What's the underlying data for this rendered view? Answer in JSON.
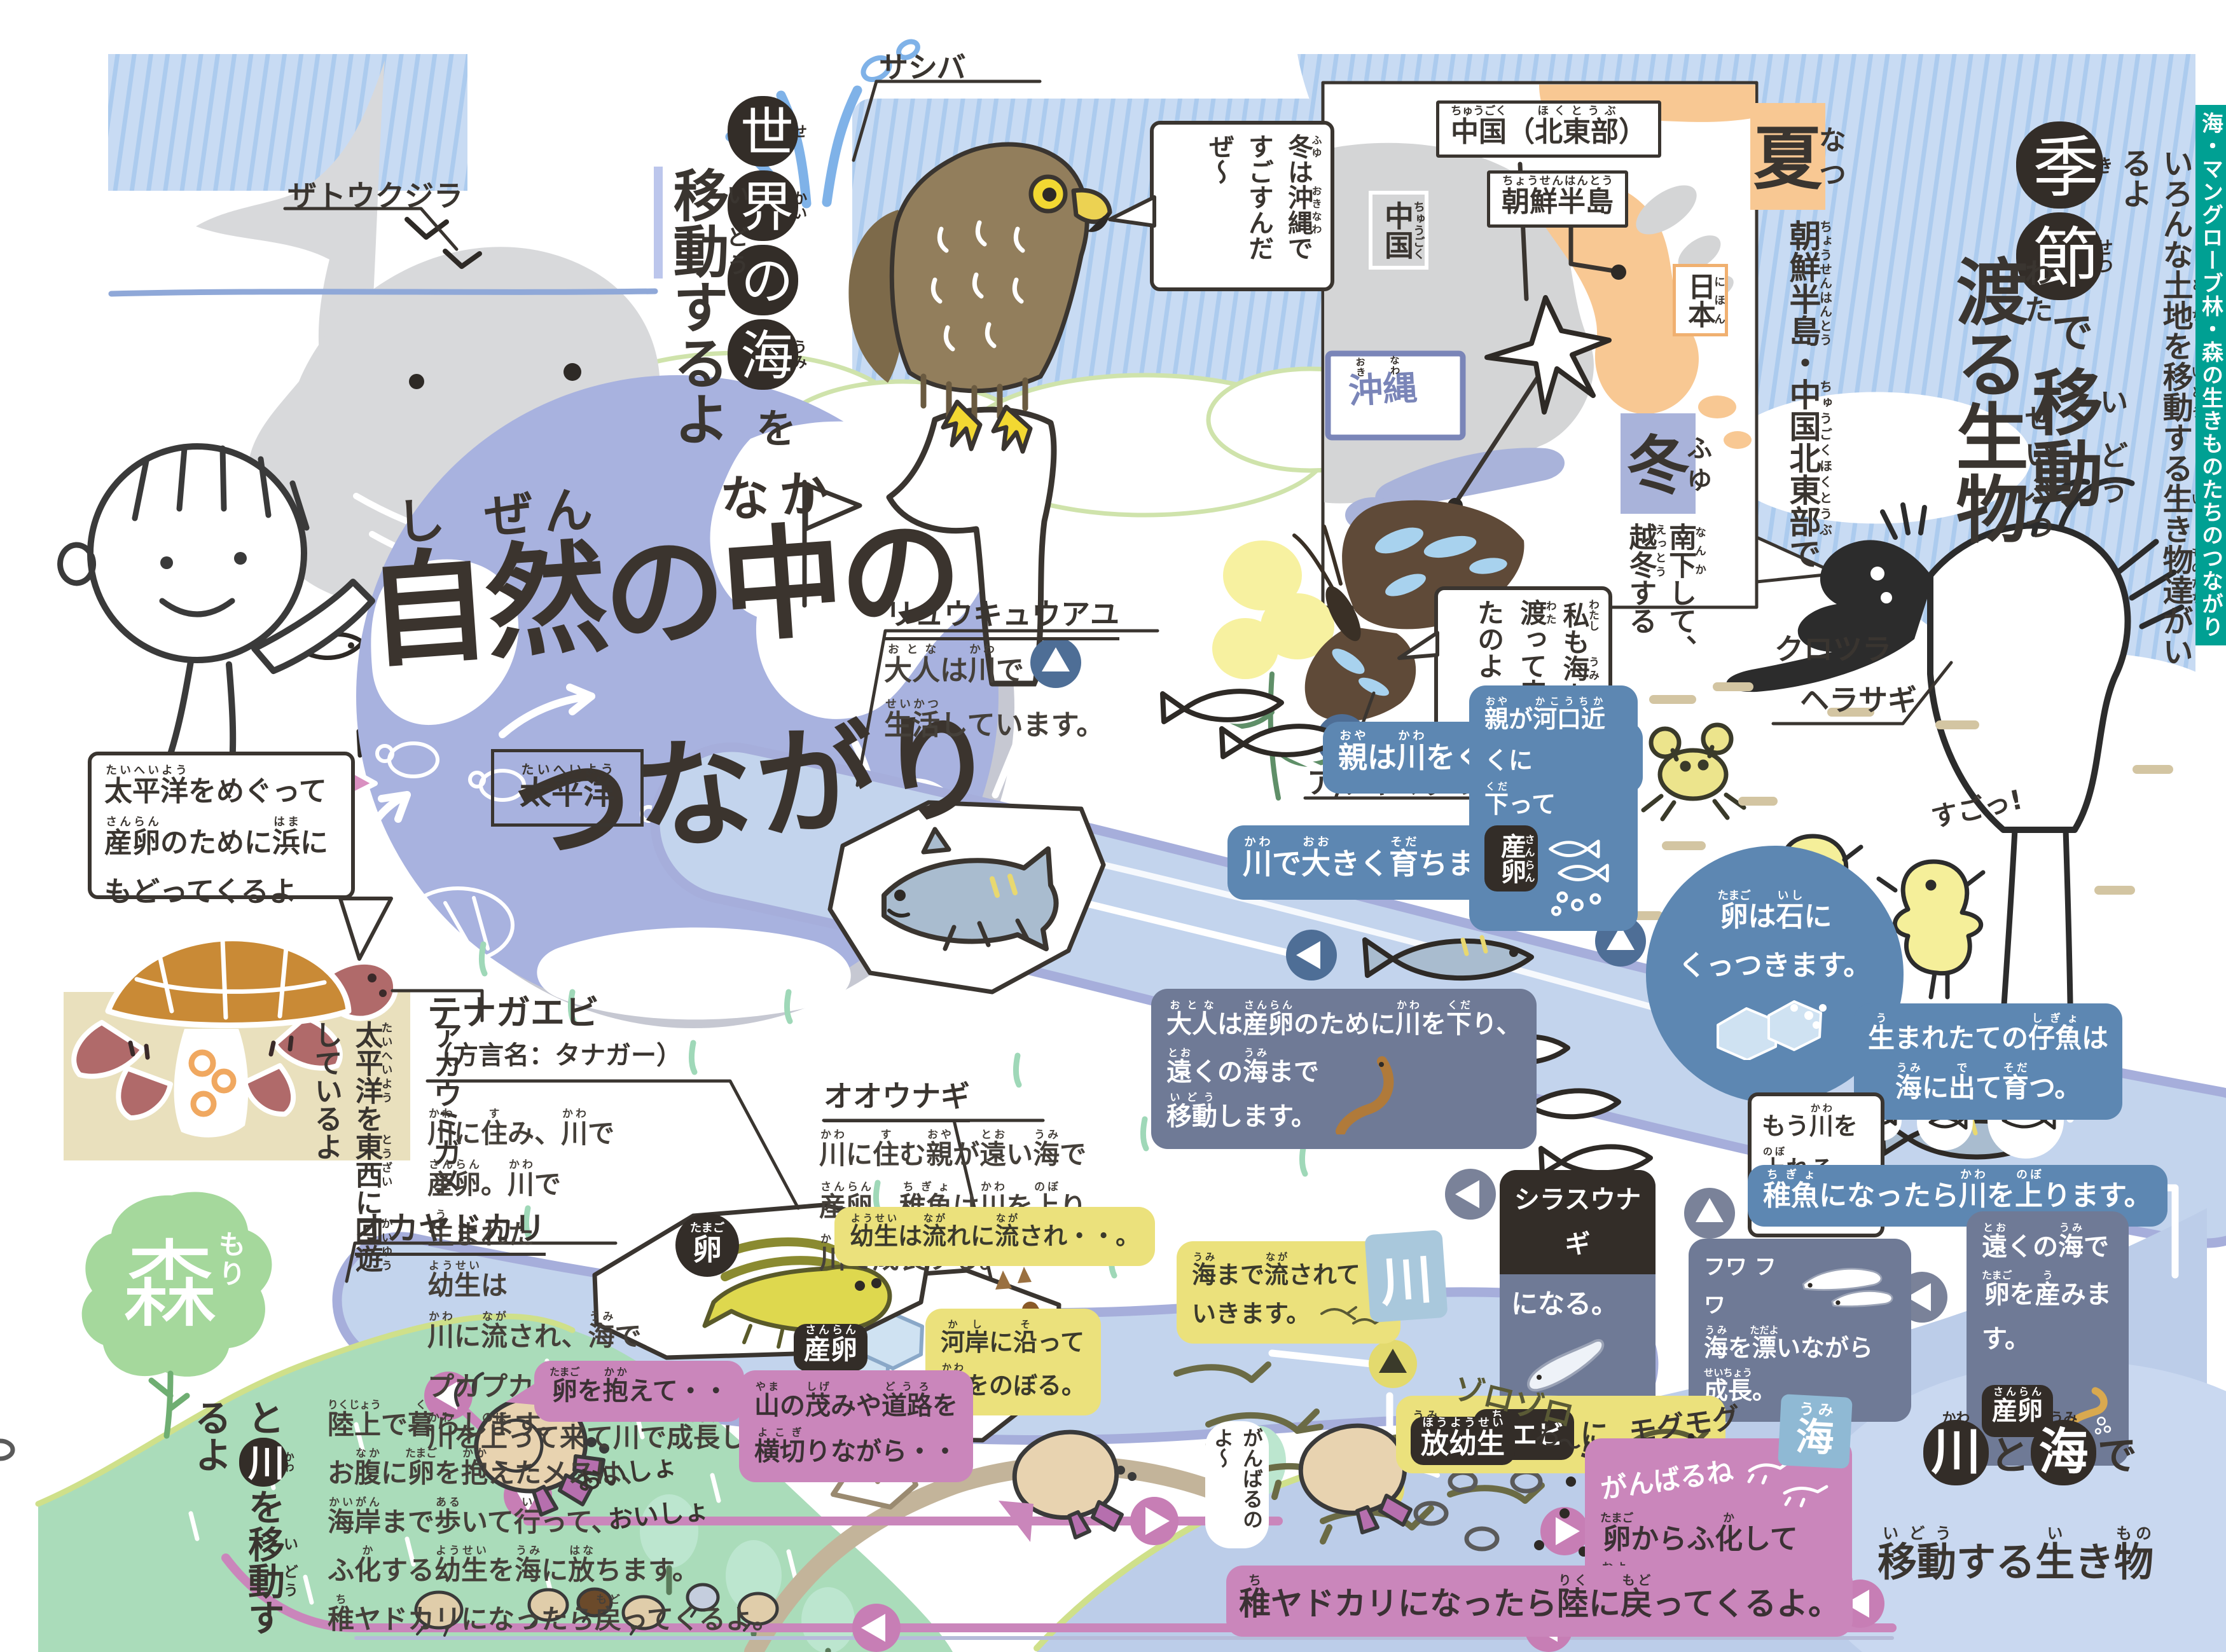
{
  "colors": {
    "accent_teal": "#00a093",
    "badge_blue": "#5d87b2",
    "badge_slate": "#6f7a96",
    "badge_yellow": "#ebe17c",
    "badge_pink": "#ca86bb",
    "badge_black": "#332d28",
    "globe": "#a8b2df",
    "river": "#c3d4ed",
    "sea": "#bccde9",
    "summer_orange": "#f8c893",
    "winter_lavender": "#a9b3da",
    "mountain_green": "#aadcba"
  },
  "tab": {
    "label": "海・マングローブ林・森の生きものたちのつながり"
  },
  "title": {
    "line1": [
      [
        "自",
        "し"
      ],
      [
        "然",
        "ぜん"
      ],
      [
        "の",
        ""
      ],
      [
        "中",
        "なか"
      ],
      [
        "の",
        ""
      ]
    ],
    "line2": "つながり"
  },
  "whale": {
    "label": "ザトウクジラ"
  },
  "world_title": {
    "part1": [
      [
        "世",
        "せ"
      ],
      [
        "界",
        "かい"
      ],
      [
        "の",
        ""
      ],
      [
        "海",
        "うみ"
      ]
    ],
    "part2": "を",
    "part3": [
      [
        "移",
        "い"
      ],
      [
        "動",
        "どう"
      ],
      [
        "するよ",
        ""
      ]
    ]
  },
  "hawk": {
    "label": "サシバ",
    "bubble": [
      [
        "冬",
        "ふゆ"
      ],
      [
        "は",
        ""
      ],
      [
        "沖縄",
        "おきなわ"
      ],
      [
        "ですごすんだぜ～",
        ""
      ]
    ]
  },
  "map": {
    "china_ne": [
      [
        "中国",
        "ちゅうごく"
      ],
      [
        "（",
        ""
      ],
      [
        "北東部",
        "ほくとうぶ"
      ],
      [
        "）",
        ""
      ]
    ],
    "korea": [
      [
        "朝鮮半島",
        "ちょうせんはんとう"
      ]
    ],
    "china": [
      [
        "中国",
        "ちゅうごく"
      ]
    ],
    "japan": [
      [
        "日本",
        "にほん"
      ]
    ],
    "okinawa": [
      [
        "沖",
        "おき"
      ],
      [
        "縄",
        "なわ"
      ]
    ],
    "summer": [
      [
        "夏",
        "なつ"
      ]
    ],
    "winter": [
      [
        "冬",
        "ふゆ"
      ]
    ],
    "winter_note": [
      [
        "南下",
        "なんか"
      ],
      [
        "して、",
        ""
      ],
      [
        "越冬",
        "えっとう"
      ],
      [
        "する",
        ""
      ]
    ],
    "breeding_note": [
      [
        "朝鮮半島",
        "ちょうせんはんとう"
      ],
      [
        "・",
        ""
      ],
      [
        "中国北東部",
        "ちゅうごくほくとうぶ"
      ],
      [
        "で",
        ""
      ]
    ]
  },
  "season": {
    "t1": [
      [
        "季",
        "き"
      ],
      [
        "節",
        "せつ"
      ]
    ],
    "t2": "で",
    "t3": [
      [
        "移",
        "い"
      ],
      [
        "動",
        "どう"
      ]
    ],
    "t4": [
      [
        "渡",
        "わた"
      ],
      [
        "る",
        ""
      ],
      [
        "生",
        "せい"
      ],
      [
        "物",
        "ぶつ"
      ]
    ],
    "subtitle": [
      [
        "いろんな",
        ""
      ],
      [
        "土地",
        "とち"
      ],
      [
        "を",
        ""
      ],
      [
        "移動",
        "いどう"
      ],
      [
        "する",
        ""
      ],
      [
        "生",
        "い"
      ],
      [
        "き",
        ""
      ],
      [
        "物達",
        "ものたち"
      ],
      [
        "がいるよ",
        ""
      ]
    ]
  },
  "butterfly": {
    "label": "アサギマダラ",
    "bubble": [
      [
        "私",
        "わたし"
      ],
      [
        "も",
        ""
      ],
      [
        "海",
        "うみ"
      ],
      [
        "を",
        ""
      ],
      [
        "渡",
        "わた"
      ],
      [
        "って",
        ""
      ],
      [
        "来",
        "き"
      ],
      [
        "たのよ",
        ""
      ]
    ]
  },
  "spoonbill": {
    "label_l1": "クロツラ",
    "label_l2": "ヘラサギ",
    "chick_note": "すごっ!"
  },
  "globe": {
    "ocean": [
      [
        "太平洋",
        "たいへいよう"
      ]
    ],
    "turtle_bubble_l1": [
      [
        "太平洋",
        "たいへいよう"
      ],
      [
        "をめぐって",
        ""
      ]
    ],
    "turtle_bubble_l2": [
      [
        "産卵",
        "さんらん"
      ],
      [
        "のために",
        ""
      ],
      [
        "浜",
        "はま"
      ],
      [
        "に",
        ""
      ]
    ],
    "turtle_bubble_l3": [
      [
        "もどってくるよ",
        ""
      ]
    ]
  },
  "loggerhead": {
    "label": "アカウミガメ",
    "note": [
      [
        "太平洋",
        "たいへいよう"
      ],
      [
        "を",
        ""
      ],
      [
        "東西",
        "とうざい"
      ],
      [
        "に",
        ""
      ],
      [
        "回遊",
        "かいゆう"
      ],
      [
        "しているよ",
        ""
      ]
    ]
  },
  "ayu": {
    "name": "リュウキュウアユ",
    "desc_l1": [
      [
        "大人",
        "おとな"
      ],
      [
        "は",
        ""
      ],
      [
        "川",
        "かわ"
      ],
      [
        "で",
        ""
      ]
    ],
    "desc_l2": [
      [
        "生活",
        "せいかつ"
      ],
      [
        "しています。",
        ""
      ]
    ],
    "s1": [
      [
        "親",
        "おや"
      ],
      [
        "は",
        ""
      ],
      [
        "川",
        "かわ"
      ],
      [
        "を",
        ""
      ],
      [
        "くだります。",
        ""
      ]
    ],
    "s2": [
      [
        "川",
        "かわ"
      ],
      [
        "で",
        ""
      ],
      [
        "大",
        "おお"
      ],
      [
        "きく",
        ""
      ],
      [
        "育",
        "そだ"
      ],
      [
        "ちます。",
        ""
      ]
    ],
    "s3_l1": [
      [
        "親",
        "おや"
      ],
      [
        "が",
        ""
      ],
      [
        "河口近",
        "かこうちか"
      ],
      [
        "くに",
        ""
      ]
    ],
    "s3_l2": [
      [
        "下",
        "くだ"
      ],
      [
        "って",
        ""
      ]
    ],
    "s3_l3": [
      [
        "産卵",
        "さんらん"
      ],
      [
        "。",
        ""
      ]
    ],
    "s3_badge": [
      [
        "産",
        "さん"
      ],
      [
        "卵",
        "らん"
      ]
    ],
    "s4_l1": [
      [
        "卵",
        "たまご"
      ],
      [
        "は",
        ""
      ],
      [
        "石",
        "いし"
      ],
      [
        "に",
        ""
      ]
    ],
    "s4_l2": [
      [
        "くっつきます。",
        ""
      ]
    ],
    "s5_l1": [
      [
        "生",
        "う"
      ],
      [
        "まれたての",
        ""
      ],
      [
        "仔魚",
        "しぎょ"
      ],
      [
        "は",
        ""
      ]
    ],
    "s5_l2": [
      [
        "海",
        "うみ"
      ],
      [
        "に",
        ""
      ],
      [
        "出",
        "で"
      ],
      [
        "て",
        ""
      ],
      [
        "育",
        "そだ"
      ],
      [
        "つ。",
        ""
      ]
    ],
    "bubble_l1": [
      [
        "もう",
        ""
      ],
      [
        "川",
        "かわ"
      ],
      [
        "を",
        ""
      ]
    ],
    "bubble_l2": [
      [
        "上",
        "のぼ"
      ],
      [
        "れるよ！",
        ""
      ]
    ],
    "s6": [
      [
        "稚魚",
        "ちぎょ"
      ],
      [
        "になったら",
        ""
      ],
      [
        "川",
        "かわ"
      ],
      [
        "を",
        ""
      ],
      [
        "上",
        "のぼ"
      ],
      [
        "ります。",
        ""
      ]
    ]
  },
  "eel": {
    "name": "オオウナギ",
    "desc_l1": [
      [
        "川",
        "かわ"
      ],
      [
        "に",
        ""
      ],
      [
        "住",
        "す"
      ],
      [
        "む",
        ""
      ],
      [
        "親",
        "おや"
      ],
      [
        "が",
        ""
      ],
      [
        "遠",
        "とお"
      ],
      [
        "い",
        ""
      ],
      [
        "海",
        "うみ"
      ],
      [
        "で",
        ""
      ]
    ],
    "desc_l2": [
      [
        "産卵",
        "さんらん"
      ],
      [
        "。",
        ""
      ],
      [
        "稚魚",
        "ちぎょ"
      ],
      [
        "は",
        ""
      ],
      [
        "川",
        "かわ"
      ],
      [
        "を",
        ""
      ],
      [
        "上",
        "のぼ"
      ],
      [
        "り、",
        ""
      ]
    ],
    "desc_l3": [
      [
        "川",
        "かわ"
      ],
      [
        "で",
        ""
      ],
      [
        "成長",
        "せいちょう"
      ],
      [
        "する。",
        ""
      ]
    ],
    "s1_l1": [
      [
        "大人",
        "おとな"
      ],
      [
        "は",
        ""
      ],
      [
        "産卵",
        "さんらん"
      ],
      [
        "のために",
        ""
      ],
      [
        "川",
        "かわ"
      ],
      [
        "を",
        ""
      ],
      [
        "下",
        "くだ"
      ],
      [
        "り、",
        ""
      ]
    ],
    "s1_l2": [
      [
        "遠",
        "とお"
      ],
      [
        "くの",
        ""
      ],
      [
        "海",
        "うみ"
      ],
      [
        "まで",
        ""
      ]
    ],
    "s1_l3": [
      [
        "移動",
        "いどう"
      ],
      [
        "します。",
        ""
      ]
    ],
    "s2_l1": [
      [
        "遠",
        "とお"
      ],
      [
        "くの",
        ""
      ],
      [
        "海",
        "うみ"
      ],
      [
        "で",
        ""
      ]
    ],
    "s2_l2": [
      [
        "卵",
        "たまご"
      ],
      [
        "を",
        ""
      ],
      [
        "産",
        "う"
      ],
      [
        "みます。",
        ""
      ]
    ],
    "spawn": [
      [
        "産卵",
        "さんらん"
      ]
    ],
    "s3_title": "シラスウナギ",
    "s3_rest": "になる。",
    "s4": [
      [
        "海",
        "うみ"
      ],
      [
        "を",
        ""
      ],
      [
        "漂",
        "ただよ"
      ],
      [
        "いながら",
        ""
      ],
      [
        "成長",
        "せいちょう"
      ],
      [
        "。",
        ""
      ]
    ],
    "float_note": "フワ フワ"
  },
  "shrimp": {
    "name": "テナガエビ",
    "alias": "（方言名：タナガー）",
    "desc_lines": [
      [
        [
          "川",
          "かわ"
        ],
        [
          "に",
          ""
        ],
        [
          "住",
          "す"
        ],
        [
          "み、",
          ""
        ],
        [
          "川",
          "かわ"
        ],
        [
          "で",
          ""
        ]
      ],
      [
        [
          "産卵",
          "さんらん"
        ],
        [
          "。",
          ""
        ],
        [
          "川",
          "かわ"
        ],
        [
          "で",
          ""
        ]
      ],
      [
        [
          "生",
          "う"
        ],
        [
          "まれた",
          ""
        ]
      ],
      [
        [
          "幼生",
          "ようせい"
        ],
        [
          "は",
          ""
        ]
      ],
      [
        [
          "川",
          "かわ"
        ],
        [
          "に",
          ""
        ],
        [
          "流",
          "なが"
        ],
        [
          "され、",
          ""
        ],
        [
          "海",
          "うみ"
        ],
        [
          "で",
          ""
        ]
      ],
      [
        [
          "プカプカ",
          ""
        ],
        [
          "浮",
          "う"
        ],
        [
          "きながら",
          ""
        ],
        [
          "育",
          "そだ"
        ],
        [
          "ち、",
          ""
        ]
      ],
      [
        [
          "川",
          "かわ"
        ],
        [
          "を",
          ""
        ],
        [
          "上",
          "のぼ"
        ],
        [
          "って",
          ""
        ],
        [
          "来",
          "き"
        ],
        [
          "て",
          ""
        ],
        [
          "川",
          "かわ"
        ],
        [
          "で",
          ""
        ],
        [
          "成長",
          "せいちょう"
        ],
        [
          "します。",
          ""
        ]
      ]
    ],
    "egg_badge": [
      [
        "卵",
        "たまご"
      ]
    ],
    "spawn_badge": [
      [
        "産卵",
        "さんらん"
      ]
    ],
    "s1": [
      [
        "幼生",
        "ようせい"
      ],
      [
        "は",
        ""
      ],
      [
        "流",
        "なが"
      ],
      [
        "れに",
        ""
      ],
      [
        "流",
        "なが"
      ],
      [
        "され・・。",
        ""
      ]
    ],
    "s2_l1": [
      [
        "河岸",
        "かし"
      ],
      [
        "に",
        ""
      ],
      [
        "沿",
        "そ"
      ],
      [
        "って",
        ""
      ]
    ],
    "s2_l2": [
      [
        "川",
        "かわ"
      ],
      [
        "をのぼる。",
        ""
      ]
    ],
    "s3_l1": [
      [
        "海",
        "うみ"
      ],
      [
        "まで",
        ""
      ],
      [
        "流",
        "なが"
      ],
      [
        "されて",
        ""
      ]
    ],
    "s3_l2": [
      [
        "いきます。",
        ""
      ]
    ],
    "s4_pre": [
      [
        "海",
        "うみ"
      ],
      [
        "で",
        ""
      ]
    ],
    "s4_badge": [
      [
        "稚",
        "ち"
      ],
      [
        "エビ",
        ""
      ]
    ],
    "s4_post": "に",
    "munch": "モグモグ",
    "crowd": "ゾロゾロ"
  },
  "hermit": {
    "name": "オカヤドカリ",
    "desc_lines": [
      [
        [
          "陸上",
          "りくじょう"
        ],
        [
          "で",
          ""
        ],
        [
          "暮",
          "く"
        ],
        [
          "らします。",
          ""
        ]
      ],
      [
        [
          "お",
          ""
        ],
        [
          "腹",
          "なか"
        ],
        [
          "に",
          ""
        ],
        [
          "卵",
          "たまご"
        ],
        [
          "を",
          ""
        ],
        [
          "抱",
          "かか"
        ],
        [
          "えたメスは、",
          ""
        ]
      ],
      [
        [
          "海岸",
          "かいがん"
        ],
        [
          "まで",
          ""
        ],
        [
          "歩",
          "ある"
        ],
        [
          "いて",
          ""
        ],
        [
          "行",
          "い"
        ],
        [
          "って、",
          ""
        ]
      ],
      [
        [
          "ふ",
          ""
        ],
        [
          "化",
          "か"
        ],
        [
          "する",
          ""
        ],
        [
          "幼生",
          "ようせい"
        ],
        [
          "を",
          ""
        ],
        [
          "海",
          "うみ"
        ],
        [
          "に",
          ""
        ],
        [
          "放",
          "はな"
        ],
        [
          "ちます。",
          ""
        ]
      ],
      [
        [
          "稚",
          "ち"
        ],
        [
          "ヤドカリになったら",
          ""
        ],
        [
          "戻",
          "もど"
        ],
        [
          "ってくるよ。",
          ""
        ]
      ]
    ],
    "b1": [
      [
        "卵",
        "たまご"
      ],
      [
        "を",
        ""
      ],
      [
        "抱",
        "かか"
      ],
      [
        "えて・・",
        ""
      ]
    ],
    "heave_l1": "おいしょ",
    "heave_l2": "おいしょ",
    "b2_l1": [
      [
        "山",
        "やま"
      ],
      [
        "の",
        ""
      ],
      [
        "茂",
        "しげ"
      ],
      [
        "みや",
        ""
      ],
      [
        "道路",
        "どうろ"
      ],
      [
        "を",
        ""
      ]
    ],
    "b2_l2": [
      [
        "横切",
        "よこぎ"
      ],
      [
        "りながら・・",
        ""
      ]
    ],
    "cheer1": "がんばるのよ～",
    "release": [
      [
        "放幼生",
        "ほうようせい"
      ]
    ],
    "wa_note": "わ〜!",
    "cheer2": "がんばるね",
    "hatch_l1": [
      [
        "卵",
        "たまご"
      ],
      [
        "からふ",
        ""
      ],
      [
        "化",
        "か"
      ],
      [
        "して",
        ""
      ]
    ],
    "hatch_l2": [
      [
        "泳",
        "およ"
      ],
      [
        "ぎだすよ。",
        ""
      ]
    ],
    "return": [
      [
        "稚",
        "ち"
      ],
      [
        "ヤドカリになったら",
        ""
      ],
      [
        "陸",
        "りく"
      ],
      [
        "に",
        ""
      ],
      [
        "戻",
        "もど"
      ],
      [
        "ってくるよ。",
        ""
      ]
    ]
  },
  "forest": {
    "tree": [
      [
        "森",
        "もり"
      ]
    ],
    "v1": "と",
    "v2": [
      [
        "川",
        "かわ"
      ]
    ],
    "v3": [
      [
        "を",
        ""
      ],
      [
        "移",
        "い"
      ],
      [
        "動",
        "どう"
      ],
      [
        "するよ",
        ""
      ]
    ]
  },
  "signs": {
    "river": "川",
    "sea": [
      [
        "海",
        "うみ"
      ]
    ]
  },
  "bottom_title": {
    "c1": [
      [
        "川",
        "かわ"
      ]
    ],
    "j1": "と",
    "c2": [
      [
        "海",
        "うみ"
      ]
    ],
    "j2": "で",
    "line2": [
      [
        "移動",
        "いどう"
      ],
      [
        "する",
        ""
      ],
      [
        "生",
        "い"
      ],
      [
        "き",
        ""
      ],
      [
        "物",
        "もの"
      ]
    ]
  }
}
